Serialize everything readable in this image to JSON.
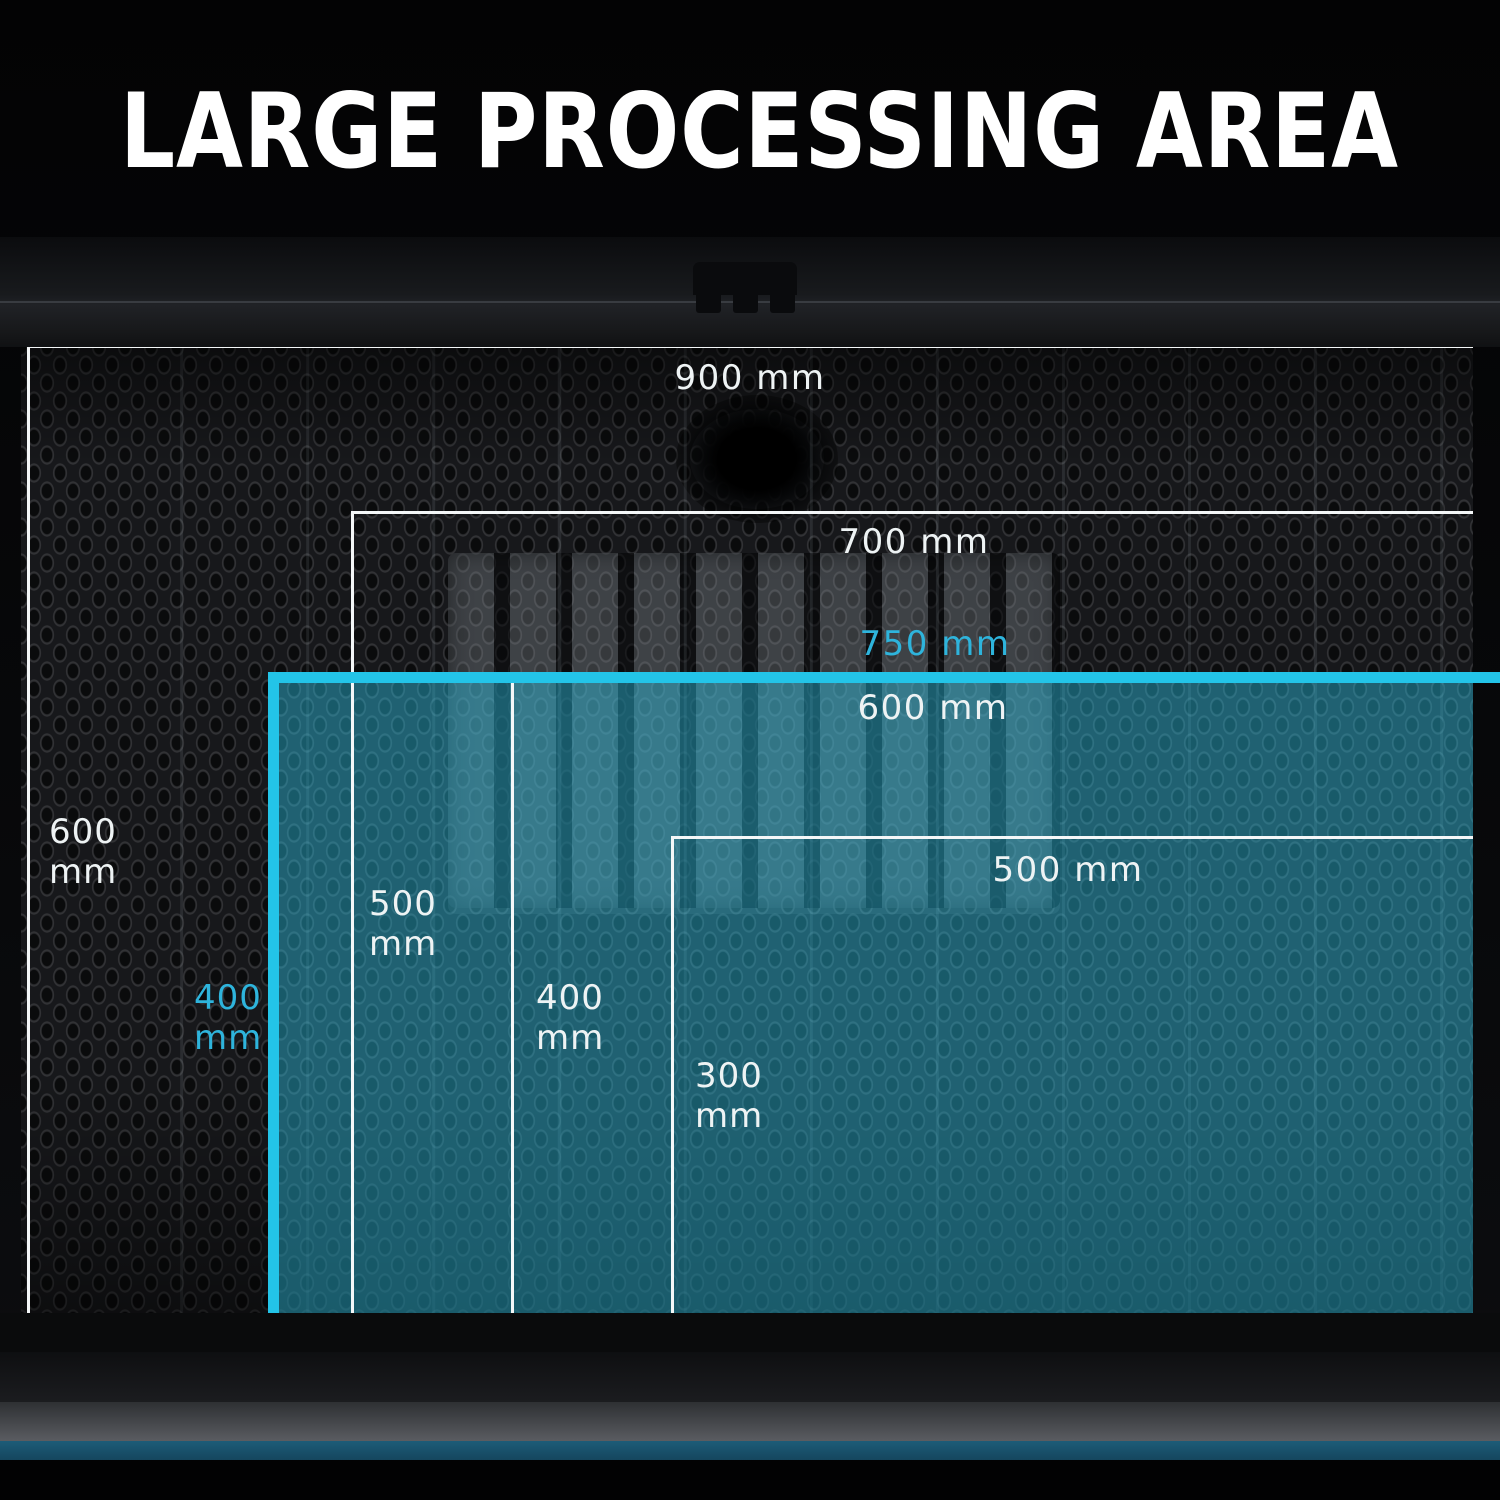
{
  "title": "LARGE PROCESSING AREA",
  "areas": [
    {
      "name": "900 x 600 mm",
      "width_label": "900 mm",
      "height_value": "600",
      "height_unit": "mm",
      "style": "white"
    },
    {
      "name": "700 x 500 mm",
      "width_label": "700 mm",
      "height_value": "500",
      "height_unit": "mm",
      "style": "white"
    },
    {
      "name": "750 x 400 mm",
      "width_label": "750 mm",
      "height_value": "400",
      "height_unit": "mm",
      "style": "cyan-highlight"
    },
    {
      "name": "600 x 400 mm",
      "width_label": "600 mm",
      "height_value": "400",
      "height_unit": "mm",
      "style": "white"
    },
    {
      "name": "500 x 300 mm",
      "width_label": "500 mm",
      "height_value": "300",
      "height_unit": "mm",
      "style": "white"
    }
  ],
  "colors": {
    "accent_cyan_border": "#23c4e8",
    "cyan_label": "#2eb4dc",
    "highlight_fill": "rgba(45,200,235,0.42)",
    "white_label": "#eef3f4",
    "front_accent_strip": "#1d5c78",
    "background": "#050507"
  }
}
